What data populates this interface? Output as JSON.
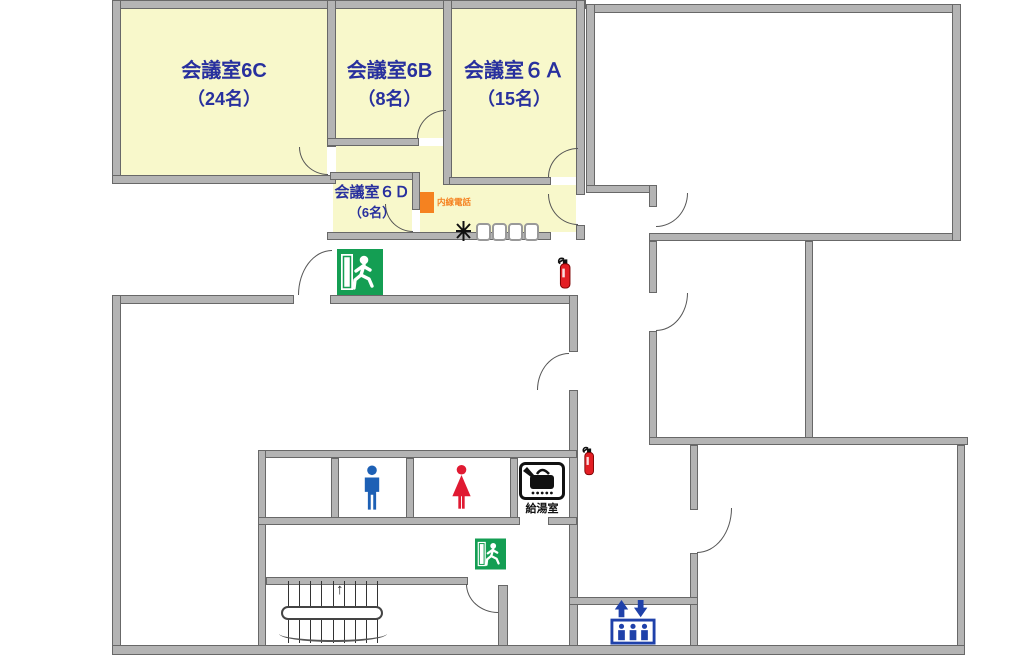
{
  "floorplan": {
    "rooms": {
      "meeting_6c": {
        "name": "会議室6C",
        "capacity": "（24名）"
      },
      "meeting_6b": {
        "name": "会議室6B",
        "capacity": "（8名）"
      },
      "meeting_6a": {
        "name": "会議室６Ａ",
        "capacity": "（15名）"
      },
      "meeting_6d": {
        "name": "会議室６Ｄ",
        "capacity": "（6名）"
      },
      "kitchenette": {
        "name": "給湯室"
      }
    },
    "annotations": {
      "intercom_phone": "内線電話",
      "stairs_up_arrow": "↑"
    },
    "icons": {
      "emergency_exit_signs": 2,
      "fire_extinguishers": 2,
      "men_restroom": "man-pictogram",
      "women_restroom": "woman-pictogram",
      "elevator": "elevator-pictogram",
      "stairs": "staircase",
      "plant": "plant-marker",
      "chairs": 4
    },
    "colors": {
      "room_fill": "#f8f8cb",
      "wall": "#b4b4b4",
      "room_text": "#28309e",
      "exit_green": "#149e53",
      "accent_orange": "#f58220",
      "men_blue": "#1d60b5",
      "women_red": "#e01a32",
      "elevator_blue": "#1f41aa",
      "extinguisher_red": "#e31e24"
    }
  }
}
